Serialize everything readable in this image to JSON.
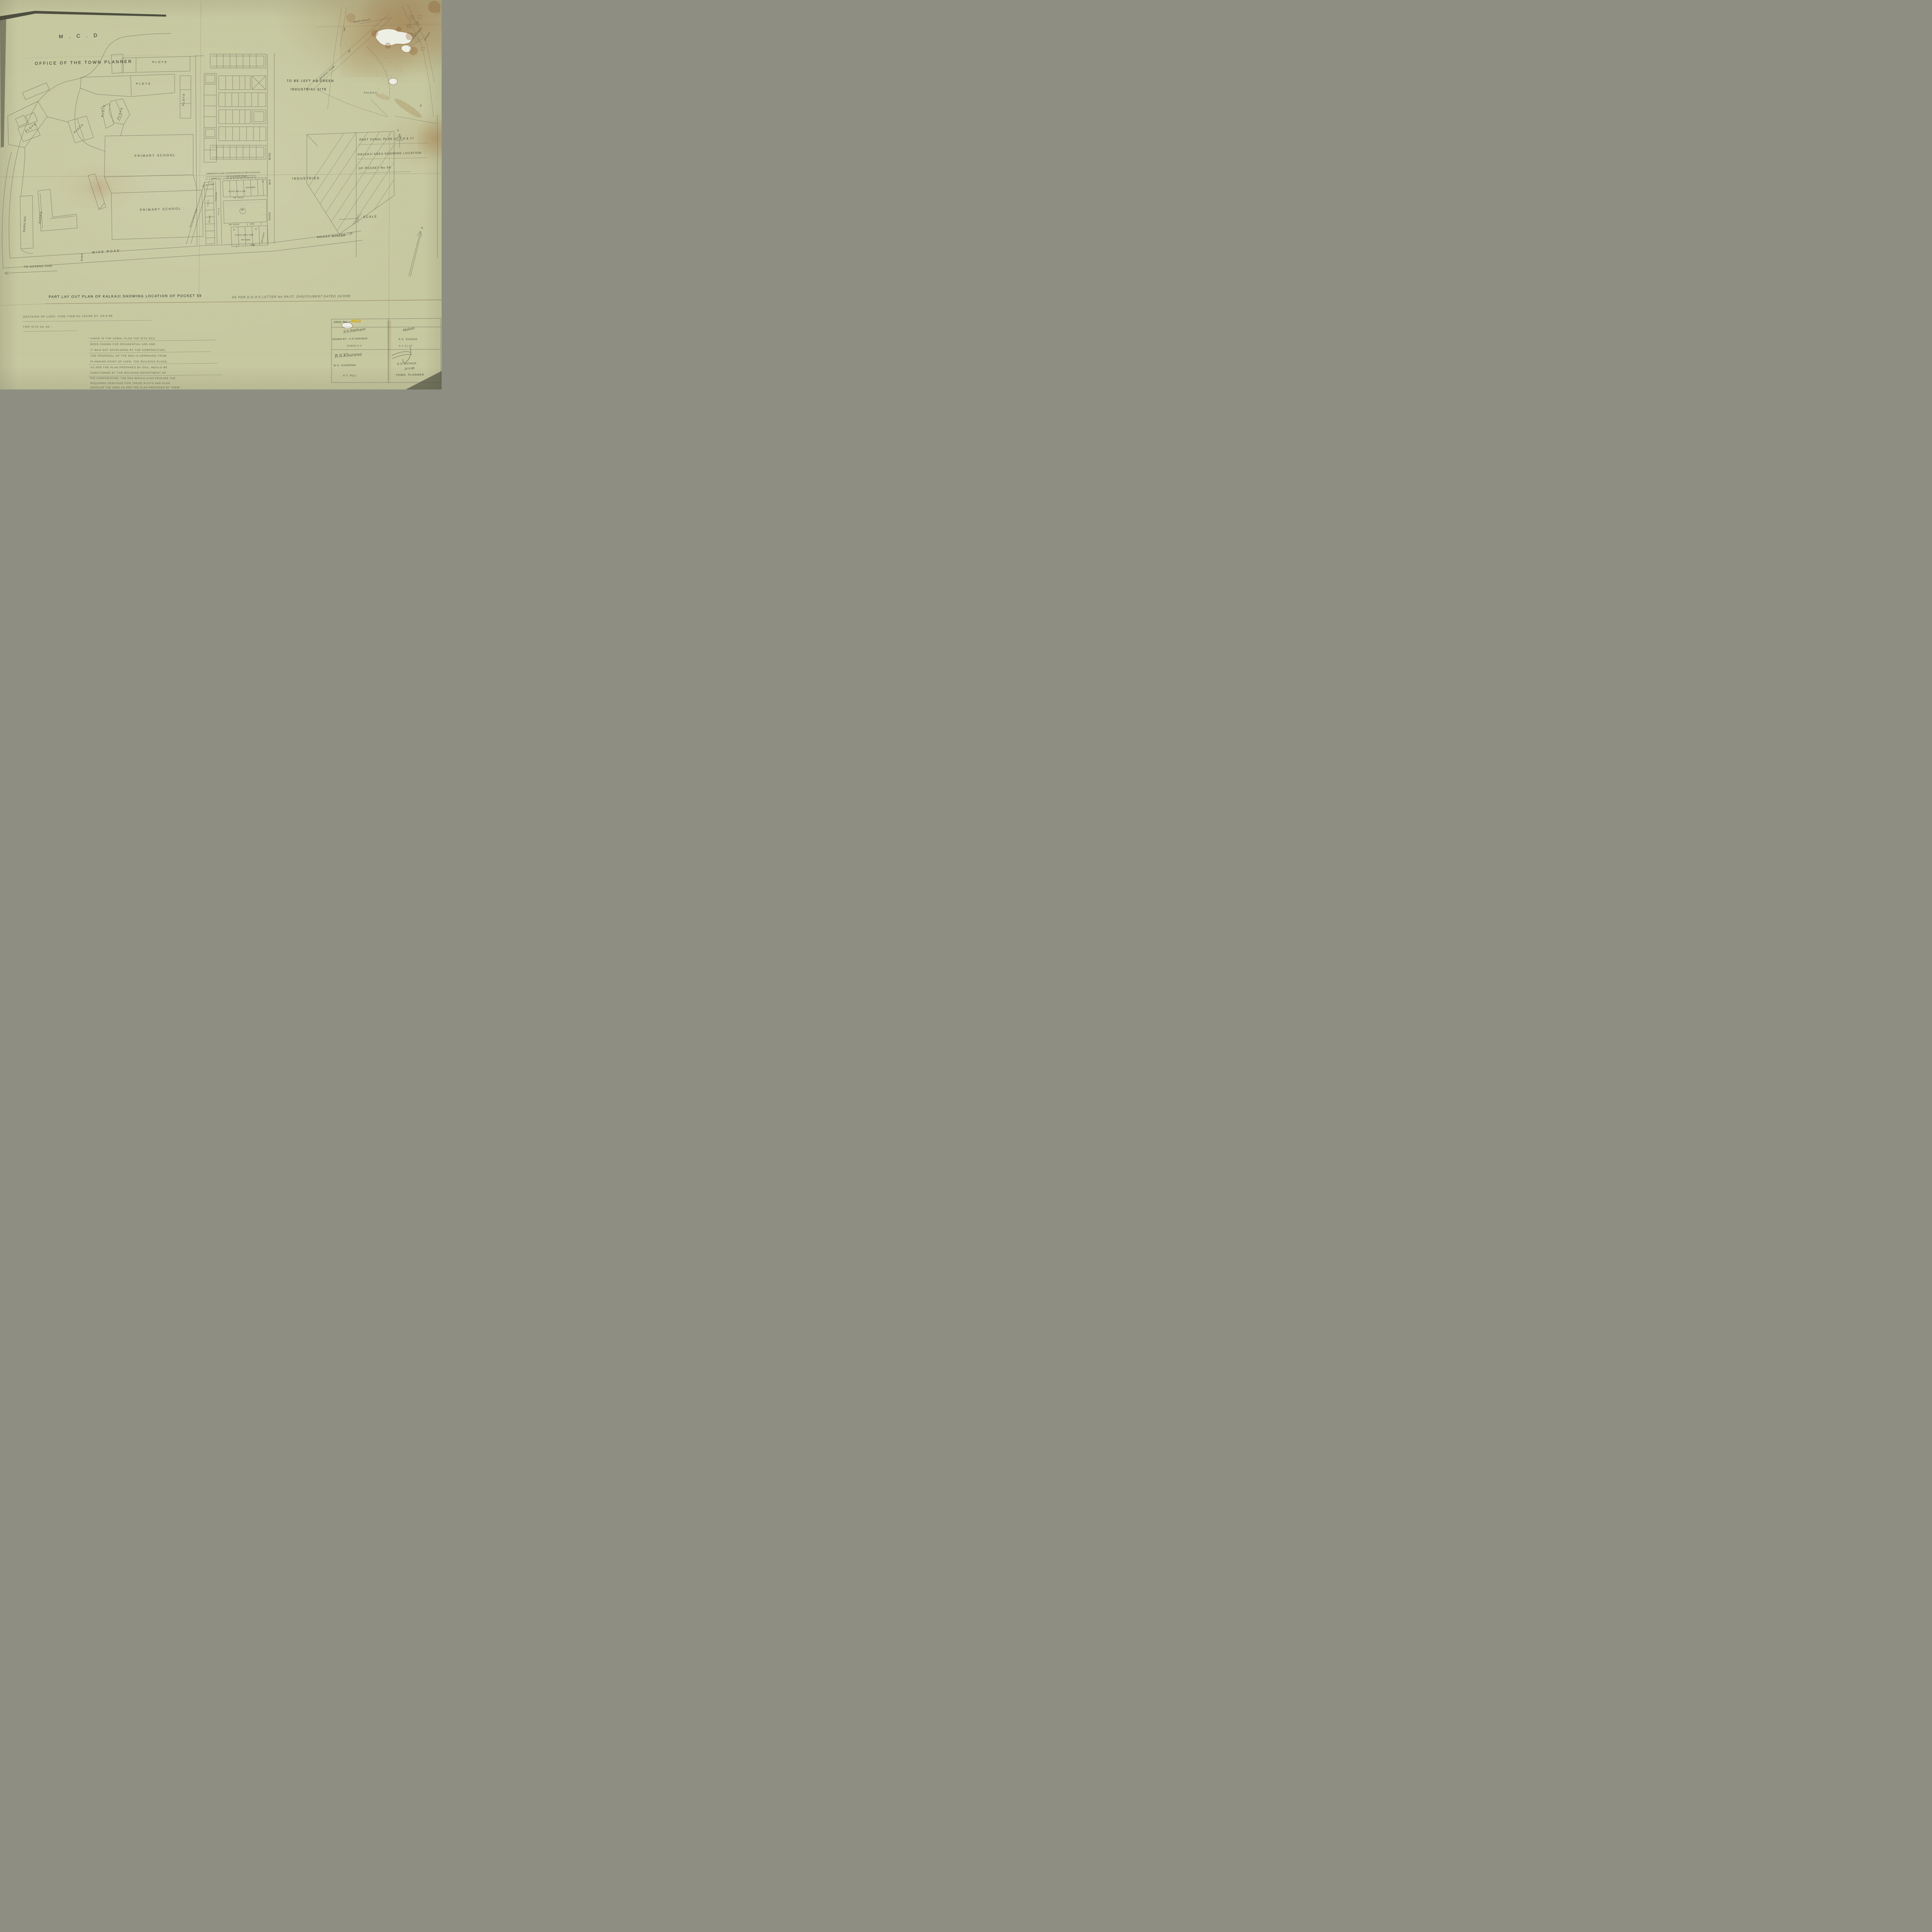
{
  "sheet": {
    "org": "M . C . D",
    "office": "OFFICE OF THE TOWN PLANNER"
  },
  "map": {
    "plots_label": "PLOTS",
    "primary_school": "PRIMARY SCHOOL",
    "parking": "PARKING",
    "shops": "SHOPS",
    "industries": "INDUSTRIES",
    "green_note_line1": "TO BE LEFT AS GREEN",
    "green_note_line2": "INDUSTRIAL SITE",
    "kalkaji_mander": "KALKAJI MANDER",
    "to_govind_puri": "TO GOVEND PURI",
    "wide_road": "WIDE ROAD",
    "road_width_3048": "30.48 M",
    "v_road_wide": "WIDE",
    "v_road_width": "50'-0\"",
    "v_road_road": "ROAD",
    "scale": "SCALE"
  },
  "pocket": {
    "dim_note": "DIMENSION & SIZE INCORPORATED AS PER SITE PLAN",
    "road_1371": "13.71 M WIDE ROAD",
    "dim_106": "10.6M",
    "road_1524": "15.24 M WIDE ROAD",
    "area_1971": "197.1 SQM",
    "area_171950": "171.950 SQM",
    "col_plots": "PLOTS",
    "col_dims": "9M X 18M",
    "road_v_small": "ROAD",
    "plots_9x18": "PLOTS 9M X 18M",
    "area_1625": "(162.5 SQM)",
    "road_3m_a": "3M ROAD",
    "road_3m_b": "3M ROAD",
    "pocket_no": "59",
    "dim_136": "13.6M",
    "plot_18": "18",
    "plot_15": "15",
    "plot_16": "16",
    "plots_12x25": "PLOTS 12M X 25M",
    "area_300": "300 SQM",
    "area_30375": "303.75 SQ.M",
    "dim_105": "10.5M",
    "dim_12m": "12M"
  },
  "inset": {
    "to_mehrauli": "TO MEHROLI ROAD",
    "nehru_place": "NEHRU PALACE",
    "kalkaji": "KALKAJI",
    "kalkaji_temple": "KALKAJI TEMPLE",
    "site_59": "SITE No 59",
    "rw": "R/W",
    "n150_a": "150",
    "n150_b": "150",
    "tiny_h": "H",
    "tiny_pl": "P.L",
    "tiny_lm1": "L.M",
    "tiny_lm2": "L.M",
    "north_small": "N",
    "north_big": "N"
  },
  "zonal_title": {
    "line1": "PART ZONAL PLAN OF F.9 & 17",
    "line2": "KALKAJI AREA SHOWING LOCATION",
    "line3": "OF POCKET No 59"
  },
  "main_title": {
    "part1": "PART LAY OUT PLAN OF KALKAJI SHOWING LOCATION OF POCKET 59",
    "part2": "AS PER D.D.A'S LETTER No PA/JT. DIR(CP)/88/87 DATED 16/3/88"
  },
  "decision": {
    "line1": "DECISION OF LOSC. VIDE ITEM No 150/88 DT. 28-6-88",
    "line2": "FOR SITE No 59 :-",
    "body": [
      "\" SINCE IN THE ZONAL PLAN THE SITE HAS",
      "BEEN SHOWN FOR RESIDENTIAL USE AND",
      "IT WAS NOT DEVELOPED BY THE CORPORATION,",
      "THE PROPOSAL OF THE DDA IS APPROVED FROM",
      "PLANNING POINT OF VIEW. THE BUILDING PLANS,",
      "AS PER THE PLAN PREPARED BY DDA, WOULD BE",
      "SANCTIONED BY THE BUILDING DEPARTMENT OF",
      "THE CORPORATION. THE DDA WOULD ALSO PROVIDE THE",
      "REQUIRED SERVICES FOR THESE PLOTS AND ALSO",
      "DEVELOP THE AREA AS PER THE PLAN PREPARED BY THEM\"."
    ]
  },
  "title_block": {
    "drg_label": "DRG. No.",
    "drg_no_highlight": "4059",
    "sig1": "S.h.Siddique",
    "sig2": "Maken",
    "sig3": "B.S.Khurana",
    "drawn_by_label": "DRAWN BY:- S.H SIDDIQUE",
    "drawn_by_role": "D/MAN G II",
    "checker_name": "K.S. SAXENA",
    "checker_role": "A.A (L) IV",
    "officer1_name": "B.S. KHURANA",
    "officer1_role": "A.T. P(L)",
    "officer2_name": "D.D MATHUR",
    "officer2_date": "26.9.88",
    "officer2_role": "TOWN. PLANNER"
  },
  "colors": {
    "paper": "#c6c8a0",
    "pencil": "#4b4f41",
    "highlight": "#d9ae10"
  }
}
